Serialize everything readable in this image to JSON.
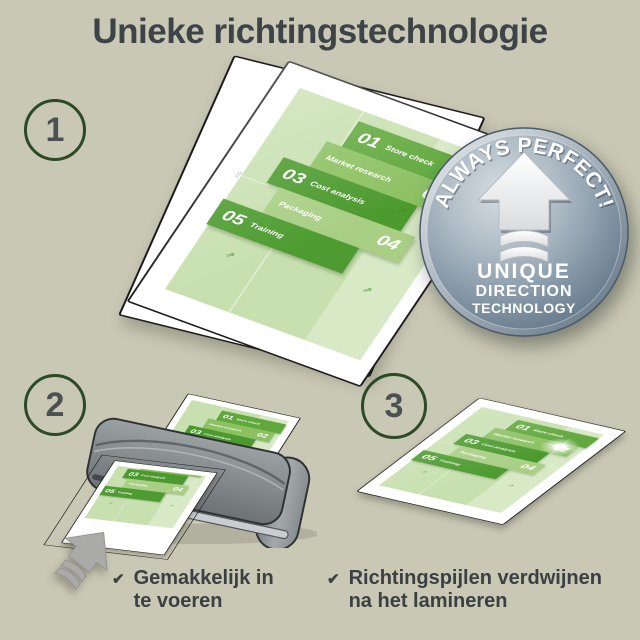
{
  "title": "Unieke richtingstechnologie",
  "steps": [
    {
      "number": "1"
    },
    {
      "number": "2",
      "caption": [
        "Gemakkelijk in",
        "te voeren"
      ]
    },
    {
      "number": "3",
      "caption": [
        "Richtingspijlen verdwijnen",
        "na het lamineren"
      ]
    }
  ],
  "badge": {
    "arc_text": "ALWAYS PERFECT!",
    "line1": "UNIQUE",
    "line2": "DIRECTION",
    "line3": "TECHNOLOGY"
  },
  "document": {
    "launch_label": "Launch",
    "blocks": [
      {
        "num": "01",
        "label": "Store check",
        "color": "#60a83c"
      },
      {
        "num": "02",
        "label": "Market research",
        "color": "#8cc162"
      },
      {
        "num": "03",
        "label": "Cost analysis",
        "color": "#4c9a2e"
      },
      {
        "num": "04",
        "label": "Packaging",
        "color": "#a9cf85"
      },
      {
        "num": "05",
        "label": "Training",
        "color": "#4e9c31"
      }
    ]
  },
  "icons": {
    "check": "✔",
    "doodle_arrow": "⇗",
    "pouch_direction_arrow": "⇧"
  },
  "colors": {
    "background": "#c9c8b4",
    "title_text": "#3e4347",
    "step_circle_border": "#2b4a25",
    "badge_body": "#7f93a4",
    "badge_text": "#ffffff",
    "doc_background": "#c8e0b0",
    "green_dark": "#4c9a2e",
    "green_light": "#a9cf85",
    "laminator_gray": "#83898b"
  }
}
